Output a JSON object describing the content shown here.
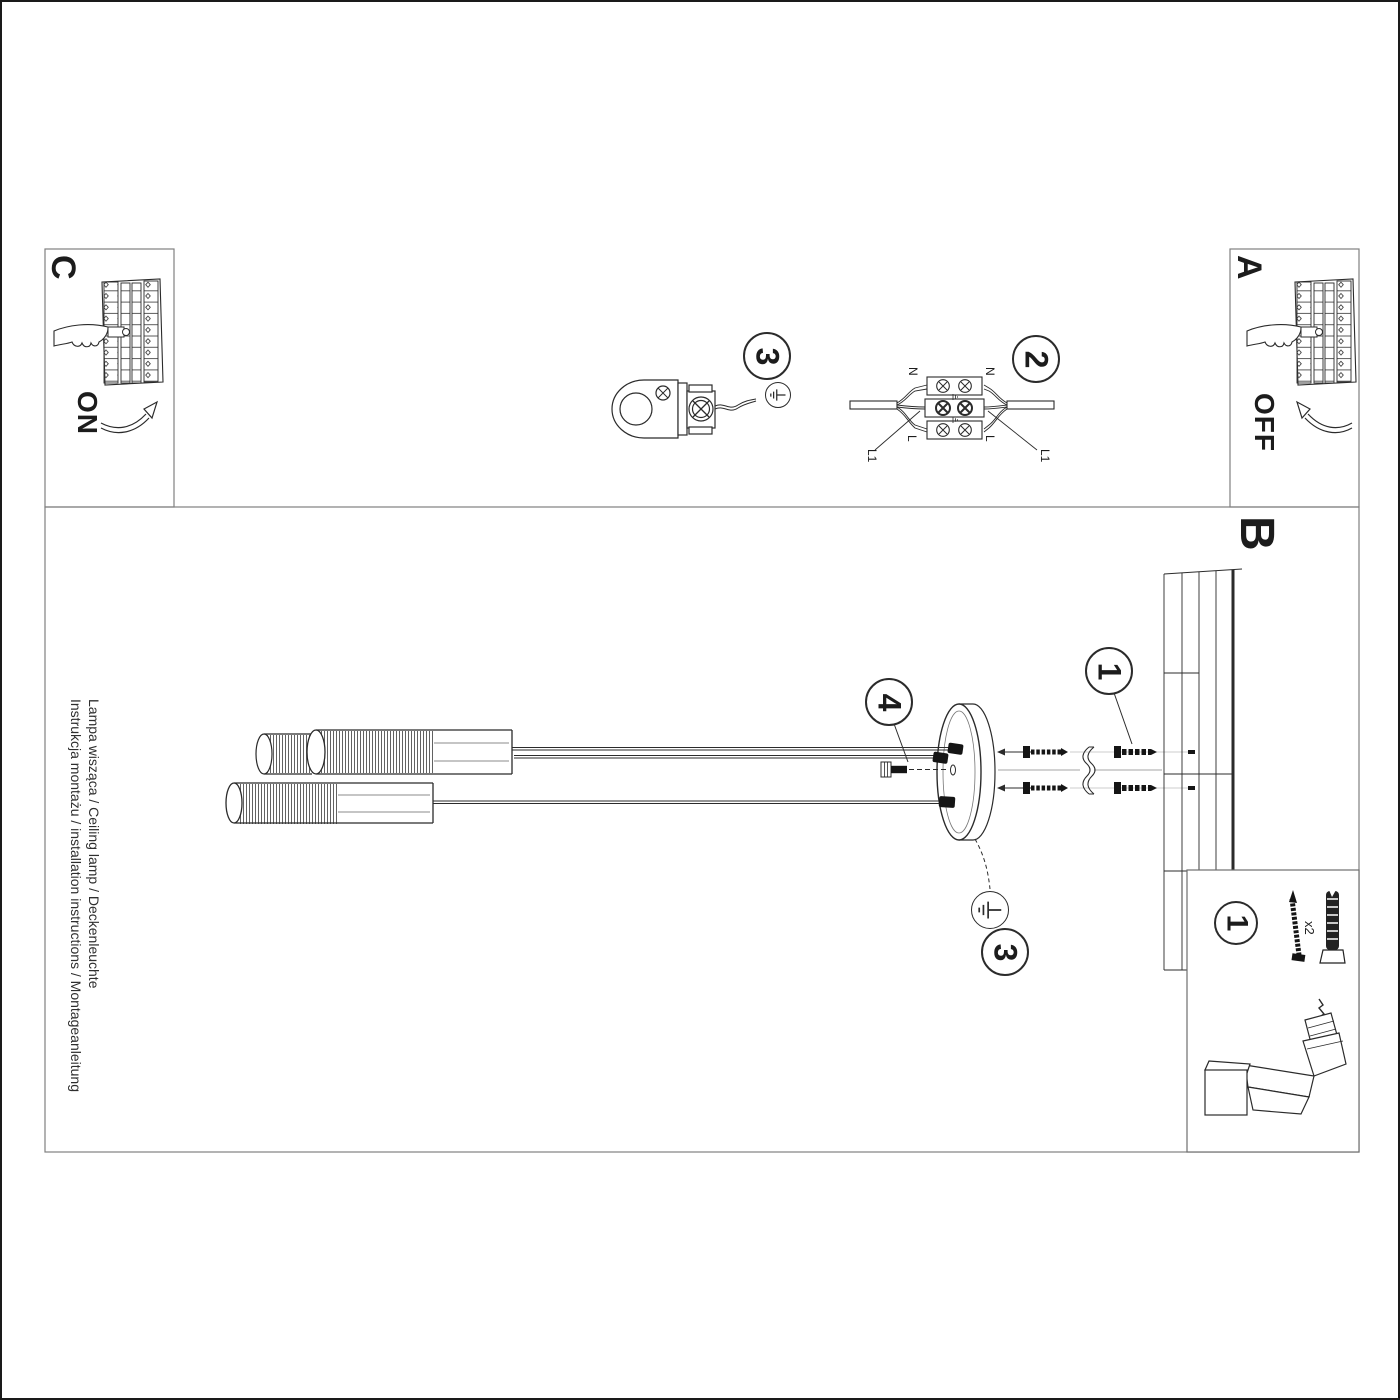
{
  "side_text": {
    "instruction_line": "Instrukcja montażu / installation instructions / Montageanleitung",
    "product_line": "Lampa wisząca / Ceiling lamp / Deckenleuchte"
  },
  "section_labels": {
    "a": "A",
    "b": "B",
    "c": "C"
  },
  "switch_states": {
    "on": "ON",
    "off": "OFF"
  },
  "step_badges": {
    "step1": "1",
    "step2": "2",
    "step3": "3",
    "step4": "4"
  },
  "terminal_labels": {
    "neutral": "N",
    "live": "L",
    "supply_live": "L1"
  },
  "parts_box": {
    "step_ref": "1",
    "quantity": "x2"
  },
  "colors": {
    "ink": "#2b2b2b",
    "frame_gray": "#808080",
    "background": "#ffffff",
    "hardware_black": "#151515"
  }
}
